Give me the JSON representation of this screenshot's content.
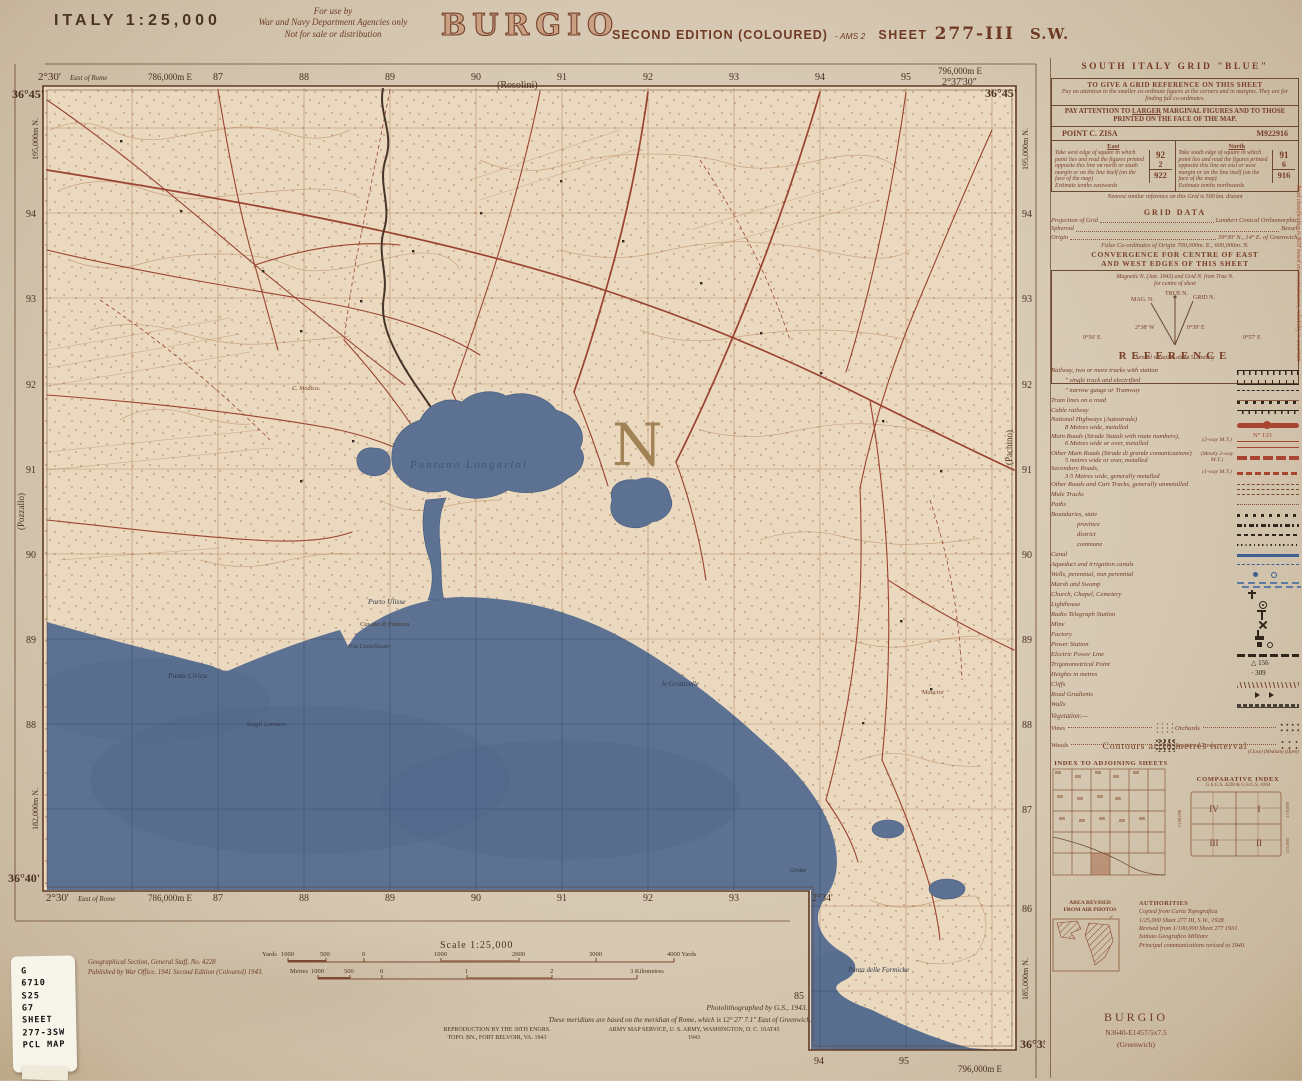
{
  "colors": {
    "paper": "#d6c8b2",
    "map_face": "#ead9bf",
    "sepia_ink": "#6e3a24",
    "road_red": "#9a4330",
    "sea_blue": "#5d7292",
    "sea_grid": "#44597c",
    "black_ink": "#30261c"
  },
  "header": {
    "country_scale": "ITALY  1:25,000",
    "use_note_l1": "For use by",
    "use_note_l2": "War and Navy Department Agencies only",
    "use_note_l3": "Not for sale or distribution",
    "title": "BURGIO",
    "edition": "SECOND EDITION (COLOURED)",
    "edition_suffix": "- AMS 2",
    "sheet_label": "SHEET",
    "sheet_number": "277-III",
    "sheet_quadrant": "S.W."
  },
  "sheet": {
    "top_lat_left": "36°45'",
    "top_lon_left": "2°30'",
    "east_of_rome": "East of Rome",
    "top_easting_left": "786,000m E",
    "top_easting_right": "796,000m E",
    "top_lon_right": "2°37'30\"",
    "top_lat_right": "36°45'",
    "rosolini": "(Rosolini)",
    "eastings": [
      "87",
      "88",
      "89",
      "90",
      "91",
      "92",
      "93",
      "94",
      "95"
    ],
    "north_left": [
      "94",
      "93",
      "92",
      "91",
      "90",
      "89",
      "88"
    ],
    "north_right": [
      "94",
      "93",
      "92",
      "91",
      "90",
      "89",
      "88",
      "87",
      "86"
    ],
    "northing_top_left": "195,000m N.",
    "northing_top_right": "195,000m N.",
    "northing_bottom_left": "182,000m N.",
    "northing_bottom_right": "185,000m N.",
    "pozzallo": "(Pozzallo)",
    "pachino": "(Pachino)",
    "bottom_lat_left": "36°40'",
    "bottom_lon_left": "2°30'",
    "bottom_easting_left": "786,000m E",
    "bottom_numbers": [
      "87",
      "88",
      "89",
      "90",
      "91",
      "92",
      "93"
    ],
    "lon_mid": "2°34'",
    "ext_85": "85",
    "ext_bottom": [
      "94",
      "95"
    ],
    "ext_easting": "796,000m E",
    "lat_br": "36°35'",
    "grid_letter": "N"
  },
  "map_labels": {
    "lagoon": "Pantano Longarini",
    "porto_ulisse": "Porto Ulisse",
    "finanza": "Cas.ma di Finanza",
    "castellazzo": "P.ta Castellazzo",
    "cirica": "Punta Cirica",
    "scogli": "Scogli Lunnaro",
    "grotticelle": "le Grotticelle",
    "formiche": "Punta delle Formiche",
    "maucini": "Maucini",
    "modica": "C. Modica",
    "grotta": "Grotta"
  },
  "scalebar": {
    "scale": "Scale 1:25,000",
    "yards_prefix": "Yards",
    "yards_ticks": [
      "1000",
      "500",
      "0",
      "1000",
      "2000",
      "3000",
      "4000 Yards"
    ],
    "metres_prefix": "Metres",
    "metres_ticks": [
      "1000",
      "500",
      "0",
      "1",
      "2",
      "3 Kilometres"
    ]
  },
  "notes": {
    "photolith": "Photolithographed by G.S., 1943.",
    "meridian": "These meridians are based on the meridian of Rome, which is 12° 27' 7.1\" East of Greenwich.",
    "repro1": "REPRODUCTION BY THE 30TH ENGRS.",
    "repro2": "TOPO. BN., FORT BELVOIR, VA. 1943",
    "ams1": "ARMY MAP SERVICE, U. S. ARMY, WASHINGTON, D. C. 10AT45",
    "ams2": "1943"
  },
  "imprint": {
    "l1": "Geographical Section, General Staff, No. 4228",
    "l2": "Published by War Office, 1941 Second Edition (Coloured) 1943."
  },
  "sticker": {
    "lines": [
      "G",
      "6710",
      "S25",
      "G7",
      "SHEET",
      "277-3SW",
      "PCL MAP"
    ]
  },
  "panel": {
    "grid_title": "SOUTH ITALY GRID \"BLUE\"",
    "refbox": {
      "heading": "TO GIVE A GRID REFERENCE ON THIS SHEET",
      "note": "Pay no attention to the smaller co-ordinate figures at the corners and in margins. They are for finding full co-ordinates.",
      "attention_1": "PAY ATTENTION TO ",
      "attention_u": "LARGER",
      "attention_2": " MARGINAL FIGURES AND TO THOSE PRINTED ON THE FACE OF THE MAP.",
      "point_label": "POINT  C. ZISA",
      "point_ref": "M922916",
      "east_label": "East",
      "east_note": "Take west edge of square in which point lies and read the figures printed opposite this line on north or south margin or on the line itself (on the face of the map)",
      "east_estimate": "Estimate tenths eastwards",
      "east_digits": "92",
      "east_tenth": "2",
      "east_total": "922",
      "north_label": "North",
      "north_note": "Take south edge of square in which point lies and read the figures printed opposite this line on east or west margin or on the line itself (on the face of the map)",
      "north_estimate": "Estimate tenths northwards",
      "north_digits": "91",
      "north_tenth": "6",
      "north_total": "916"
    },
    "repeat_note": "Nearest similar reference on this Grid is 500 km. distant",
    "grid_data": {
      "title": "GRID DATA",
      "rows": [
        [
          "Projection of Grid",
          "Lambert Conical Orthomorphic."
        ],
        [
          "Spheroid",
          "Bessel."
        ],
        [
          "Origin",
          "39°30' N., 14° E. of Greenwich."
        ]
      ],
      "last": "False Co-ordinates of Origin 700,000m. E., 600,000m. N."
    },
    "convergence": {
      "h1": "CONVERGENCE FOR CENTRE OF EAST",
      "h2": "AND WEST EDGES OF THIS SHEET",
      "note1": "Magnetic N. (Jan. 1943) and Grid N. from True N.",
      "note2": "for centre of sheet",
      "true_n": "TRUE N.",
      "mag_n": "MAG. N.",
      "grid_n": "GRID N.",
      "left_outer": "0°56' E",
      "mag_angle": "2°38' W",
      "grid_angle": "0°39' E",
      "right_outer": "0°57' E",
      "bottom": "Annual variation about 5' easterly"
    },
    "reference": {
      "title": "REFERENCE",
      "rows": [
        {
          "label": "Railway, two or more tracks with station"
        },
        {
          "label": "″   single track and electrified"
        },
        {
          "label": "″   narrow gauge or Tramway"
        },
        {
          "label": "Tram lines on a road"
        },
        {
          "label": "Cable railway"
        },
        {
          "label": "National Highways (Autostrade)",
          "label2": "8 Metres wide, metalled"
        },
        {
          "label": "Main Roads (Strade Statali with route numbers),",
          "label2": "6 Metres wide or over, metalled",
          "anno": "(2-way M.T.)",
          "route": "N° 133"
        },
        {
          "label": "Other Main Roads (Strade di grande comunicazione)",
          "label2": "5 metres wide or over, metalled",
          "anno": "(Mostly 2-way M.T.)"
        },
        {
          "label": "Secondary Roads,",
          "label2": "3·5 Metres wide, generally metalled",
          "anno": "(1-way M.T.)"
        },
        {
          "label": "Other Roads and Cart Tracks, generally unmetalled"
        },
        {
          "label": "Mule Tracks"
        },
        {
          "label": "Paths"
        },
        {
          "label": "Boundaries, state"
        },
        {
          "label": "province"
        },
        {
          "label": "district"
        },
        {
          "label": "commune"
        },
        {
          "label": "Canal"
        },
        {
          "label": "Aqueduct and irrigation canals"
        },
        {
          "label": "Wells, perennial, non perennial"
        },
        {
          "label": "Marsh and Swamp"
        },
        {
          "label": "Church, Chapel, Cemetery"
        },
        {
          "label": "Lighthouse"
        },
        {
          "label": "Radio Telegraph Station"
        },
        {
          "label": "Mine"
        },
        {
          "label": "Factory"
        },
        {
          "label": "Power Station"
        },
        {
          "label": "Electric Power Line"
        },
        {
          "label": "Trigonometrical Point",
          "symtext": "△ 156"
        },
        {
          "label": "Heights in metres",
          "symtext": "· 309"
        },
        {
          "label": "Cliffs"
        },
        {
          "label": "Road Gradients"
        },
        {
          "label": "Walls"
        }
      ],
      "road_note": "Road classification is NOT based on reconnaissance, reliability is uncertain",
      "vegetation_label": "Vegetation:—",
      "veg": [
        {
          "name": "Vines"
        },
        {
          "name": "Orchards"
        },
        {
          "name": "Woods"
        },
        {
          "name": "Scattered Trees"
        }
      ],
      "veg_sub": "(Close)  (Medium)  (Open)",
      "contours": "Contours at 10 metres interval"
    },
    "indexes": {
      "adjoining": "INDEX TO ADJOINING SHEETS",
      "comparative": "COMPARATIVE INDEX",
      "comp_sub": "G.S.G.S. 4228 & G.S.G.S. 4164",
      "quads": [
        "IV",
        "I",
        "III",
        "II"
      ],
      "scale_100": "1/100,000",
      "scale_50": "1/50,000",
      "scale_25": "1/25,000"
    },
    "area_revised": {
      "l1": "AREA REVISED",
      "l2": "FROM AIR PHOTOS"
    },
    "authorities": {
      "title": "AUTHORITIES",
      "l1": "Copied from Carta Topografica",
      "l2": "1/25,000 Sheet 277 III, S.W., 1928",
      "l3": "Revised from 1/100,000 Sheet 277 1931",
      "l4": "Istituto Geografico Militare",
      "l5": "Principal communications revised to 1940."
    },
    "footer": {
      "name": "BURGIO",
      "ref": "N3640-E1457/5x7.5",
      "greenwich": "(Greenwich)"
    }
  }
}
